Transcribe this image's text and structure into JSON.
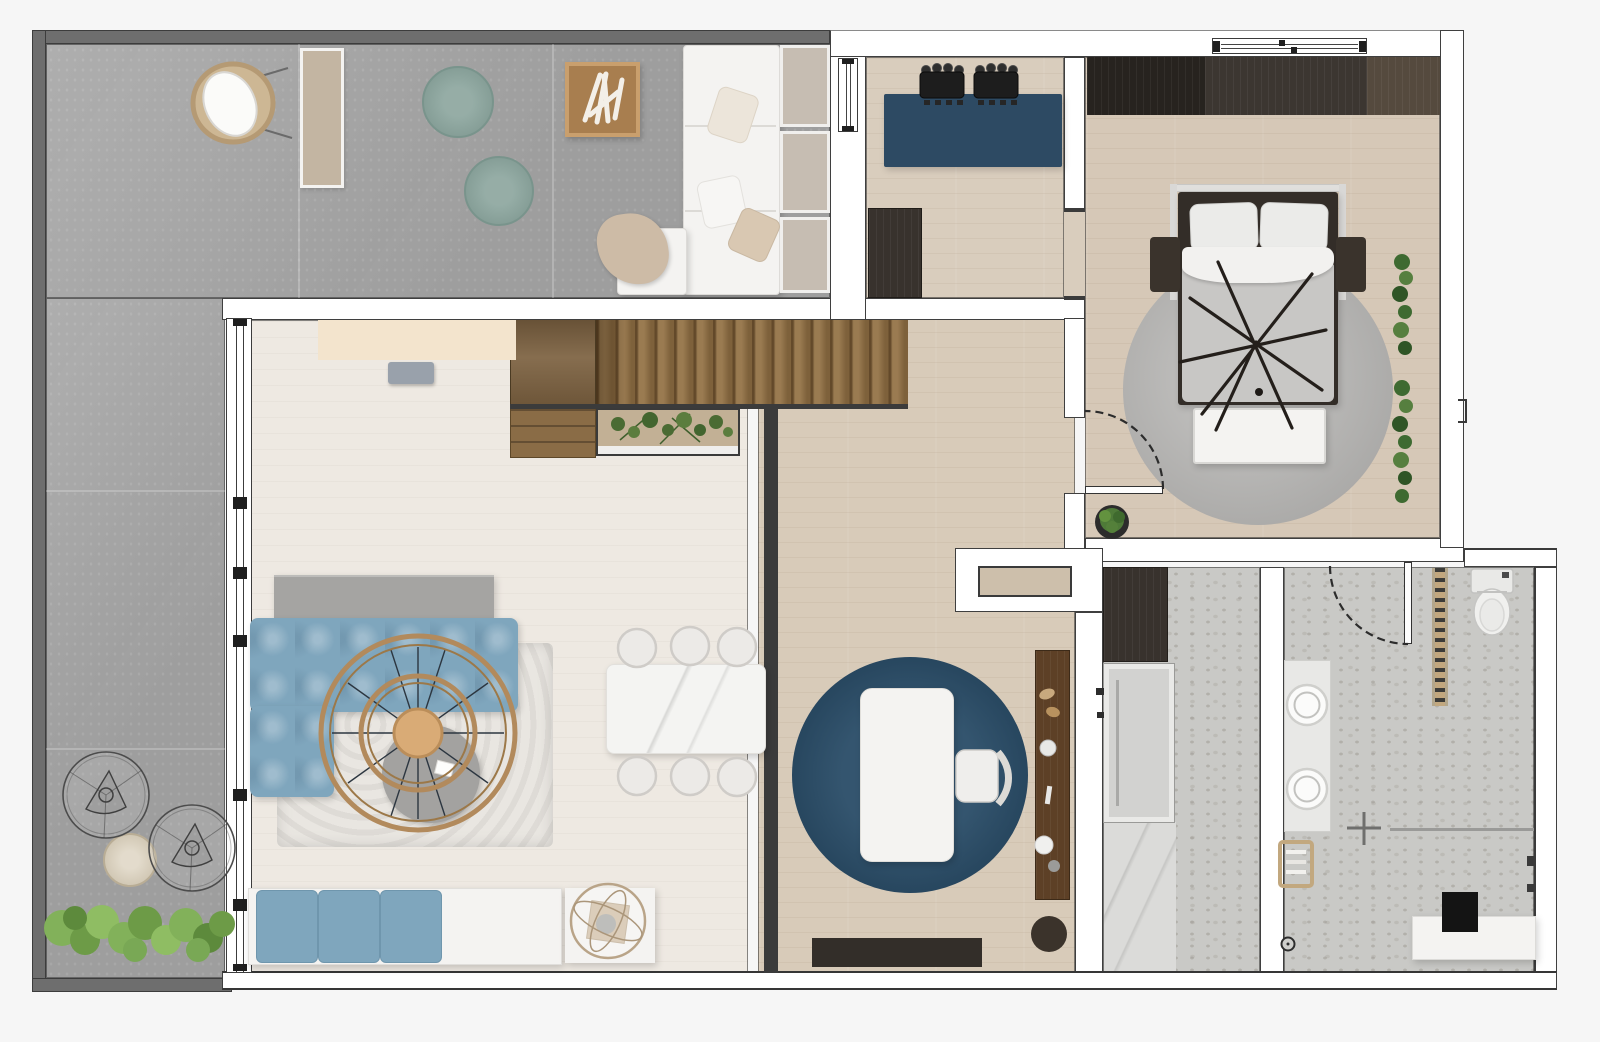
{
  "app": {
    "title": "Apartment floor plan — top-down 3D render",
    "page_bg": "#f6f6f6"
  },
  "palette": {
    "wall_fill": "#ffffff",
    "wall_line": "#3a3a3a",
    "terrace_wall": "#6e6e6e",
    "concrete": "#a8a8a8",
    "wood_living": "#eee9e2",
    "wood_hall": "#d8cbb9",
    "wood_office": "#d9cdbd",
    "wood_bedroom": "#d6c8b7",
    "stair_wood": "#8a6c44",
    "stair_cabinet": "#7c6140",
    "terrazzo": "#c9c9c6",
    "marble": "#dbdbd9",
    "navy_desk": "#2d4a63",
    "navy_rug": "#234763",
    "sofa_blue": "#7fa6bd",
    "teal_pouf": "#87a29a",
    "fur_white": "#e9e6e1",
    "fur_gray": "#b9b8b6",
    "duvet": "#c8c7c5",
    "bed_frame": "#332d28",
    "wardrobe_dark": "#27231f",
    "wardrobe_mid": "#3c3631",
    "wardrobe_light": "#554a3e",
    "dark_cabinet": "#38322d",
    "console_wood": "#5d4026",
    "ring_wood": "#b28a5c",
    "disc_wood": "#d9ab76",
    "plant_dark": "#4e7a38",
    "shrub_green": "#82b15a",
    "tan": "#c2a87f",
    "cream": "#f3e4cd",
    "sideboard": "#a5a4a2",
    "white_furn": "#f4f3f1",
    "soil": "#c2b095",
    "stool_gray": "#99a1ab",
    "dark_rug": "#332e29",
    "runner": "#c3b5a2",
    "panel": "#b3a798",
    "shower_tray": "#d2d2d0",
    "pouf_outdoor": "#d7ccb6",
    "dining_table": "#f4f4f2"
  },
  "rooms": [
    {
      "name": "terrace",
      "furniture": [
        "papasan chair",
        "runner rug",
        "teal pouf x2",
        "firewood tray",
        "white lounge sofa",
        "privacy panels x3",
        "wire lounge chair x2",
        "outdoor pouf",
        "shrub border"
      ]
    },
    {
      "name": "home-office",
      "furniture": [
        "navy desk",
        "office chair x2",
        "dark cabinet"
      ]
    },
    {
      "name": "bedroom",
      "furniture": [
        "wardrobe",
        "double bed with branch decor",
        "nightstand x2",
        "foot bench",
        "round fur rug",
        "wall plants",
        "potted plant",
        "swing door"
      ]
    },
    {
      "name": "living-dining",
      "furniture": [
        "cream console",
        "gray stool",
        "sideboard",
        "blue modular sofa",
        "white fur rug",
        "ring pendant light",
        "round coffee table",
        "marble dining table",
        "dining chair x6",
        "window seat with blue cushions",
        "side table with wire sphere"
      ]
    },
    {
      "name": "stair-hall",
      "furniture": [
        "wood staircase",
        "under-stair steps",
        "planter with greenery"
      ]
    },
    {
      "name": "study",
      "furniture": [
        "round navy rug",
        "white table",
        "chair",
        "wood console with decor",
        "dark pouf",
        "dark runner rug",
        "wall niche"
      ]
    },
    {
      "name": "shower-room",
      "furniture": [
        "dark cabinet",
        "walk-in shower tray",
        "marble floor section",
        "mixer valves"
      ]
    },
    {
      "name": "bathroom",
      "furniture": [
        "vanity with two sinks",
        "towel stool",
        "towel ladder",
        "toilet",
        "shower screen with mixer",
        "bench",
        "storage box",
        "floor drain"
      ]
    }
  ]
}
